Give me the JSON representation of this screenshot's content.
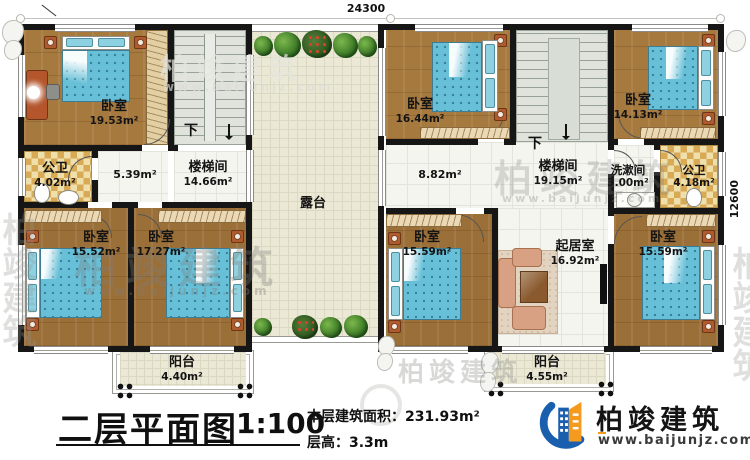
{
  "drawing": {
    "title": "二层平面图",
    "scale": "1:100",
    "building_area_label": "本层建筑面积：",
    "building_area_value": "231.93m²",
    "floor_height_label": "层高：",
    "floor_height_value": "3.3m"
  },
  "dimensions": {
    "width_mm": "24300",
    "height_mm": "12600"
  },
  "stairs": {
    "down_left": "下",
    "down_right": "下"
  },
  "rooms": {
    "bedroom_tl": {
      "name": "卧室",
      "area": "19.53m²"
    },
    "bathroom_left": {
      "name": "公卫",
      "area": "4.02m²"
    },
    "hall_left": {
      "area": "5.39m²"
    },
    "stairwell_left": {
      "name": "楼梯间",
      "area": "14.66m²"
    },
    "bedroom_bl1": {
      "name": "卧室",
      "area": "15.52m²"
    },
    "bedroom_bl2": {
      "name": "卧室",
      "area": "17.27m²"
    },
    "balcony_left": {
      "name": "阳台",
      "area": "4.40m²"
    },
    "terrace": {
      "name": "露台"
    },
    "bedroom_tr1": {
      "name": "卧室",
      "area": "16.44m²"
    },
    "bedroom_tr2": {
      "name": "卧室",
      "area": "14.13m²"
    },
    "hall_right": {
      "area": "8.82m²"
    },
    "stairwell_right": {
      "name": "楼梯间",
      "area": "19.15m²"
    },
    "washroom": {
      "name": "洗漱间",
      "area": "3.00m²"
    },
    "bathroom_right": {
      "name": "公卫",
      "area": "4.18m²"
    },
    "bedroom_br1": {
      "name": "卧室",
      "area": "15.59m²"
    },
    "living_room": {
      "name": "起居室",
      "area": "16.92m²"
    },
    "bedroom_br2": {
      "name": "卧室",
      "area": "15.59m²"
    },
    "balcony_right": {
      "name": "阳台",
      "area": "4.55m²"
    }
  },
  "watermark": {
    "brand": "柏竣建筑",
    "url": "www.baijunjz.com"
  },
  "logo": {
    "brand": "柏竣建筑",
    "url": "www.baijunjz.com"
  },
  "colors": {
    "wall": "#161616",
    "wood_floor": "#a6793f",
    "bed_blue": "#68c0d8",
    "checker_gold": "#d9aa56",
    "terrace": "#ebe8d5",
    "stair": "#dfe3dc",
    "logo_blue": "#1a5fae",
    "logo_orange": "#f49a1f"
  }
}
